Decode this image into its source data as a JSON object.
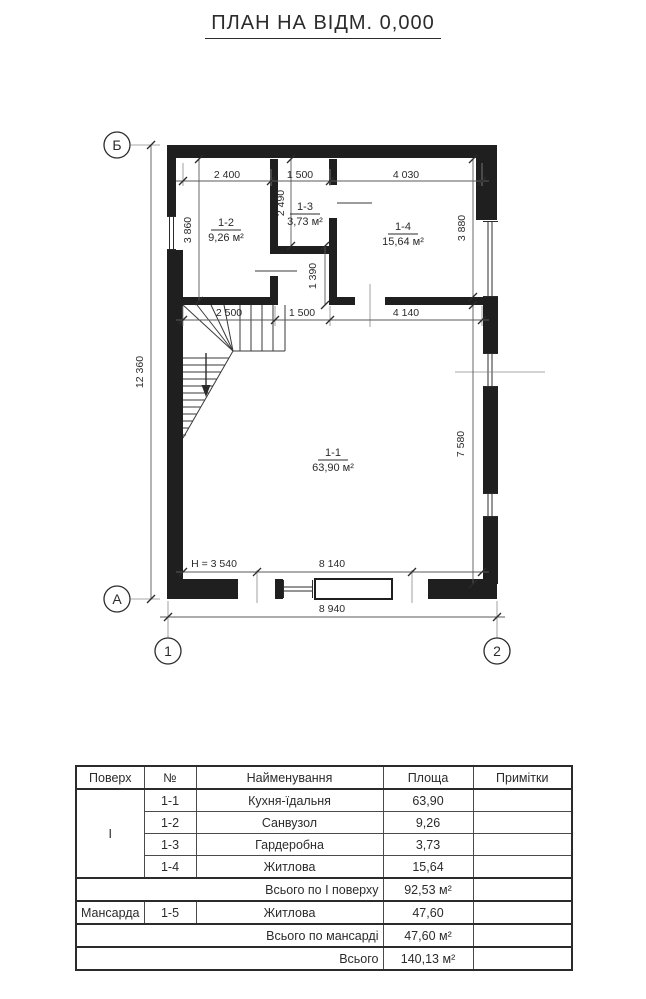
{
  "title": "ПЛАН НА ВІДМ. 0,000",
  "colors": {
    "ink": "#2b2b2b",
    "wall": "#1f1f1f",
    "dim_line": "#5a5a5a",
    "background": "#ffffff"
  },
  "plan": {
    "axis_marks": {
      "row_top": "Б",
      "row_bottom": "А",
      "col_left": "1",
      "col_right": "2"
    },
    "dimensions": {
      "top_row": [
        "2 400",
        "1 500",
        "4 030"
      ],
      "mid_row": [
        "2 500",
        "1 500",
        "4 140"
      ],
      "verticals": {
        "left_room": "3 860",
        "closet": "2 490",
        "right_room": "3 880",
        "corridor": "1 390",
        "main_room": "7 580",
        "overall_left": "12 360"
      },
      "ceiling_height": "H = 3 540",
      "bottom_inner": "8 140",
      "bottom_overall": "8 940"
    },
    "rooms": [
      {
        "id": "1-2",
        "area": "9,26 м²"
      },
      {
        "id": "1-3",
        "area": "3,73 м²"
      },
      {
        "id": "1-4",
        "area": "15,64 м²"
      },
      {
        "id": "1-1",
        "area": "63,90 м²"
      }
    ]
  },
  "table": {
    "headers": [
      "Поверх",
      "№",
      "Найменування",
      "Площа",
      "Примітки"
    ],
    "floor1_label": "I",
    "rows": [
      {
        "num": "1-1",
        "name": "Кухня-їдальня",
        "area": "63,90"
      },
      {
        "num": "1-2",
        "name": "Санвузол",
        "area": "9,26"
      },
      {
        "num": "1-3",
        "name": "Гардеробна",
        "area": "3,73"
      },
      {
        "num": "1-4",
        "name": "Житлова",
        "area": "15,64"
      }
    ],
    "total_floor1": {
      "label": "Всього по I поверху",
      "value": "92,53 м²"
    },
    "mansard_row": {
      "floor": "Мансарда",
      "num": "1-5",
      "name": "Житлова",
      "area": "47,60"
    },
    "total_mansard": {
      "label": "Всього по мансарді",
      "value": "47,60 м²"
    },
    "grand_total": {
      "label": "Всього",
      "value": "140,13 м²"
    }
  }
}
